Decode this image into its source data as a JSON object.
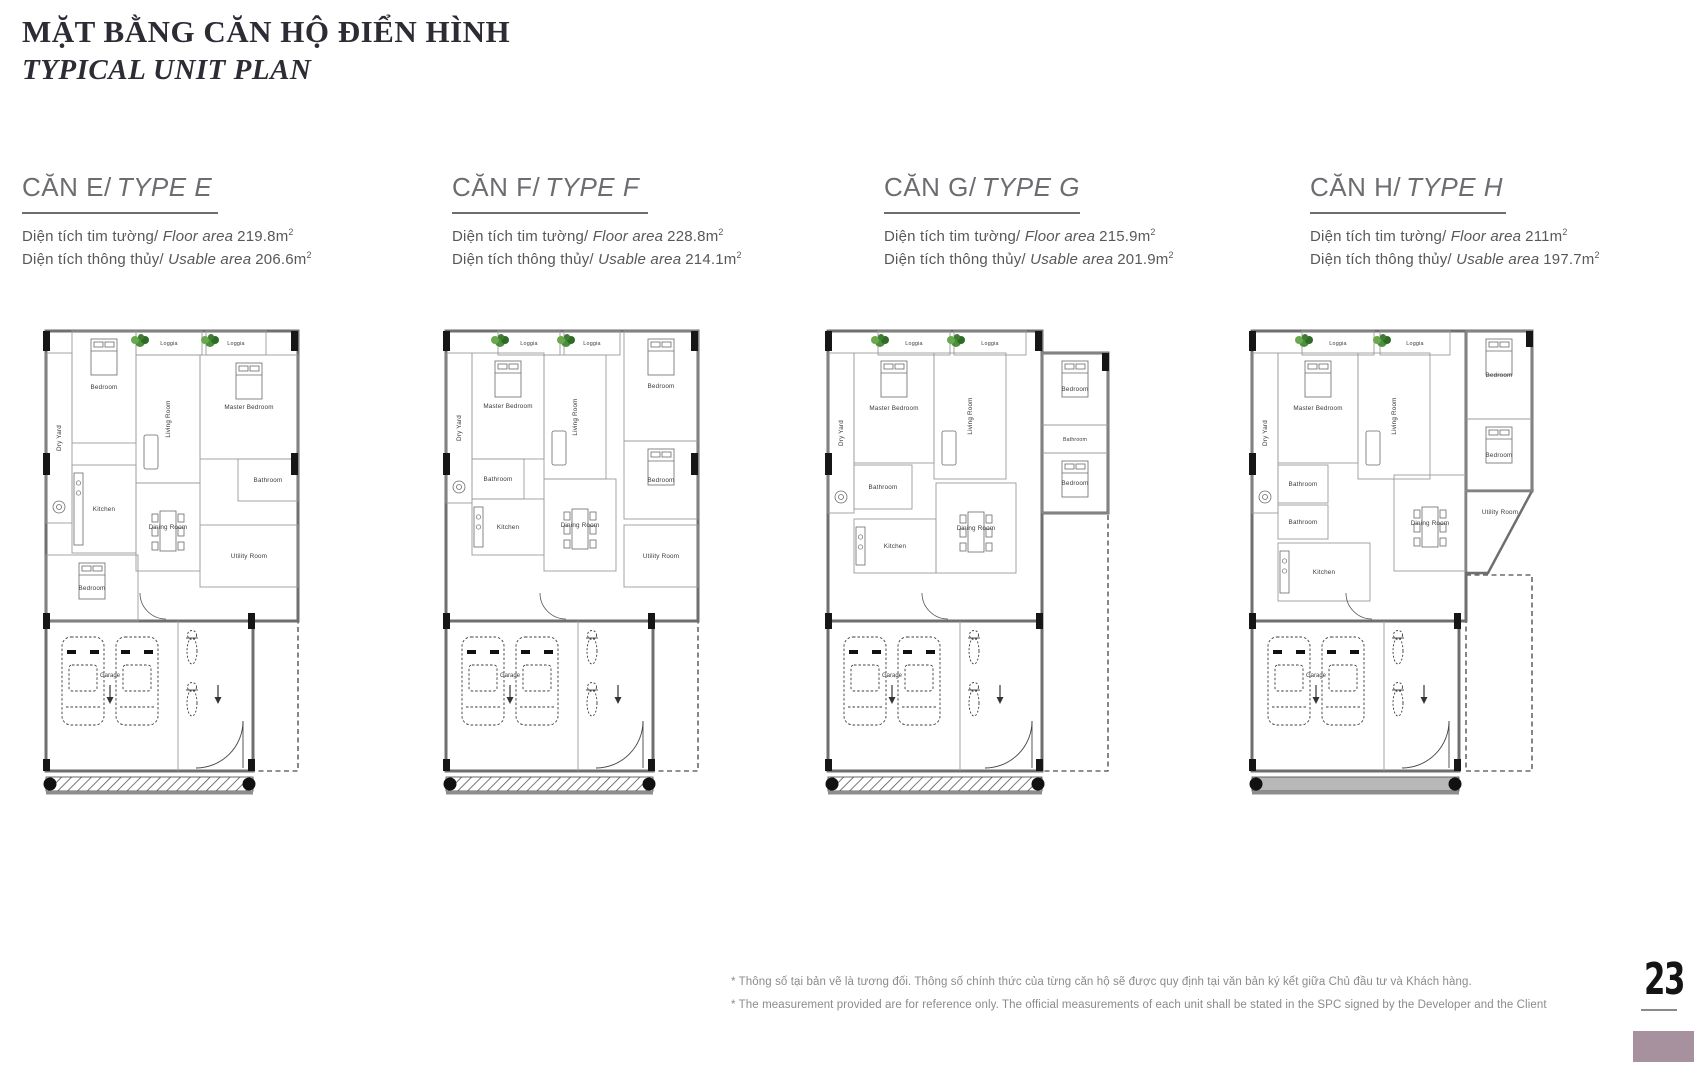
{
  "page": {
    "title_vi": "MẶT BẰNG CĂN HỘ ĐIỂN HÌNH",
    "title_en": "TYPICAL UNIT PLAN",
    "page_number": "23",
    "footnote_vi": "* Thông số tại bản vẽ là tương đối. Thông số chính thức của từng căn hộ sẽ được quy định tại văn bản ký kết giữa Chủ đầu tư và Khách hàng.",
    "footnote_en": "* The measurement provided are for reference only. The official measurements of each unit shall be stated in the SPC signed by the Developer and the Client",
    "accent_color": "#a7919e"
  },
  "labels": {
    "floor_area_vi": "Diện tích tim tường/",
    "floor_area_en": "Floor area",
    "usable_area_vi": "Diện tích thông thủy/",
    "usable_area_en": "Usable area",
    "sup": "2"
  },
  "units": [
    {
      "name_vi": "CĂN E/",
      "name_en": "TYPE E",
      "floor_area": "219.8m",
      "usable_area": "206.6m"
    },
    {
      "name_vi": "CĂN F/",
      "name_en": "TYPE F",
      "floor_area": "228.8m",
      "usable_area": "214.1m"
    },
    {
      "name_vi": "CĂN G/",
      "name_en": "TYPE G",
      "floor_area": "215.9m",
      "usable_area": "201.9m"
    },
    {
      "name_vi": "CĂN H/",
      "name_en": "TYPE H",
      "floor_area": "211m",
      "usable_area": "197.7m"
    }
  ],
  "room_labels": {
    "loggia": "Loggia",
    "bedroom": "Bedroom",
    "living_room": "Living Room",
    "master_bedroom": "Master Bedroom",
    "dry_yard": "Dry Yard",
    "bathroom": "Bathroom",
    "kitchen": "Kitchen",
    "dining_room": "Dining Room",
    "utility_room": "Utility Room",
    "garage": "Garage"
  }
}
